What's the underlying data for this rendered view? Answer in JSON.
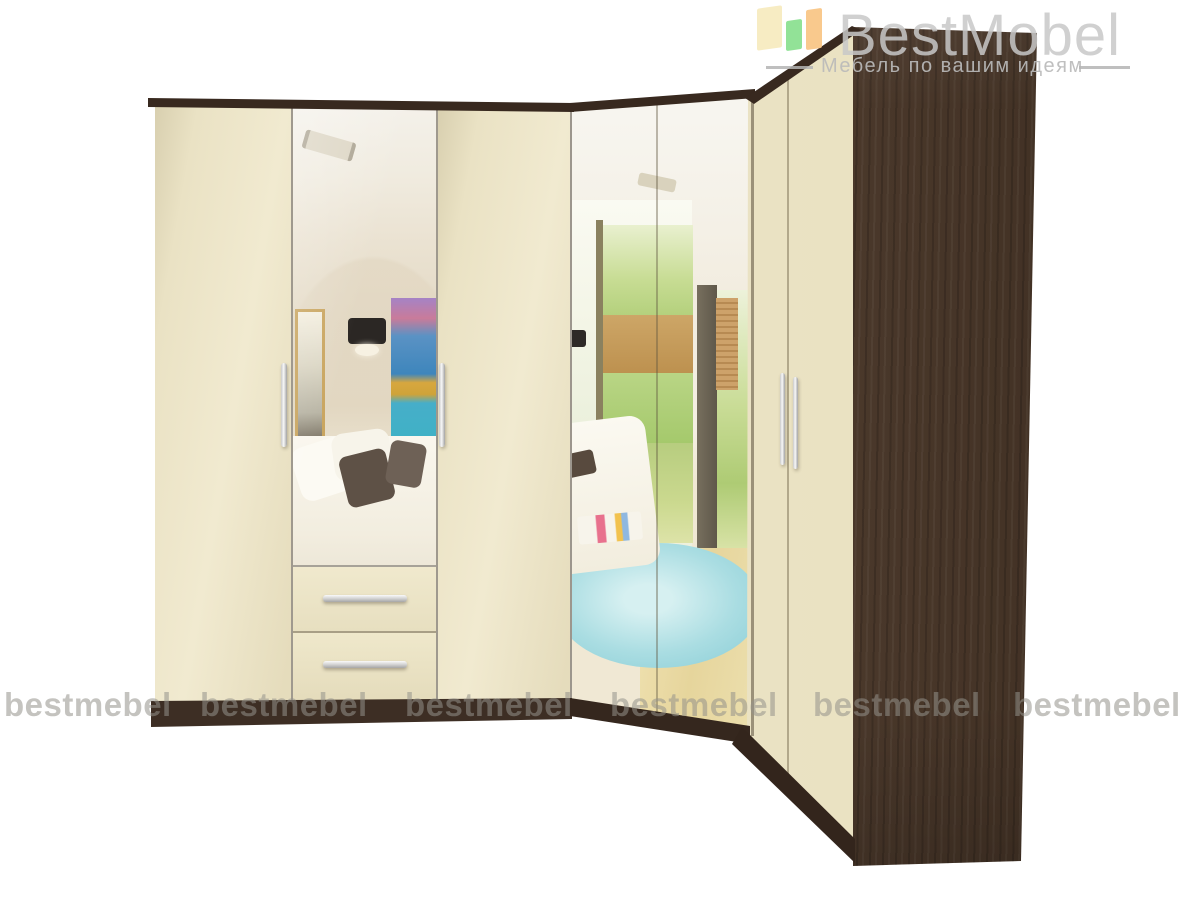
{
  "brand": {
    "logo_text": "BestMobel",
    "tagline": "Мебель по вашим идеям",
    "icon": "furniture-panels-icon",
    "icon_colors": [
      "#f6e9b9",
      "#86df8c",
      "#f9c687"
    ],
    "text_color": "#c8c8c8"
  },
  "watermark": {
    "text": "bestmebel",
    "count": 6,
    "color": "#94928a"
  },
  "product_colors": {
    "cream_door": "#ece4c6",
    "wenge_wood": "#46352a",
    "dark_trim": "#38291f",
    "chrome_handle": "#d9d9d9",
    "mirror_rug_blue": "#aadde2",
    "mirror_painting_teal": "#3fb2c5"
  }
}
